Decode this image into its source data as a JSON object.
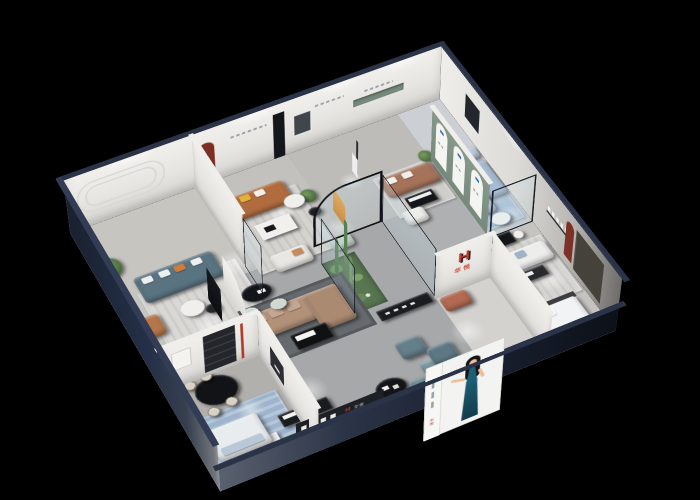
{
  "scene": {
    "description": "3D isometric cutaway render of a furniture brand showroom floor plan on a black background",
    "background": "#000000"
  },
  "brand": {
    "logo_letter": "H",
    "name": "华悦",
    "logo_color_primary": "#c23b2b",
    "logo_color_secondary": "#17181c"
  },
  "poster": {
    "subject": "woman in a dark teal evening dress on white lightbox panel",
    "background": "#f3f3f1",
    "dress_color": "#1d5f74",
    "seal_text": "华悦"
  },
  "palette": {
    "outer_wall_navy": "#212a3d",
    "inner_wall_white": "#ebe9e6",
    "floor_gray": "#aeb0b1",
    "green_accent_wall": "#7f9383",
    "red_arch_niche": "#7c2e22",
    "sofa_teal": "#5a7381",
    "sofa_caramel": "#b06c3e",
    "sofa_tan": "#b29179",
    "sofa_brown": "#a5735a",
    "sofa_light_blue": "#a6bbd4",
    "orange_accent": "#df8f2e",
    "rug_blue": "#a9bfd4",
    "plant_green": "#4e7347",
    "ottoman_teal": "#6d8c94"
  },
  "rooms": [
    {
      "id": "lounge-teal",
      "furniture": [
        "teal-sofa",
        "caramel-armchair",
        "round-coffee-tables",
        "floor-plant",
        "striped-rug",
        "wall-molding"
      ]
    },
    {
      "id": "lounge-caramel",
      "furniture": [
        "caramel-leather-sofa",
        "white-coffee-table",
        "white-loveseat",
        "red-arch-niche",
        "black-media-slab"
      ]
    },
    {
      "id": "gallery-middle",
      "furniture": [
        "orange-lounge",
        "sculpture-pedestal",
        "round-side-table",
        "wall-mirror",
        "rounded-glass-partition"
      ]
    },
    {
      "id": "lounge-brown",
      "furniture": [
        "brown-leather-sofa",
        "black-coffee-table",
        "white-armchair",
        "green-wall-niche"
      ]
    },
    {
      "id": "glass-room-blue",
      "furniture": [
        "blue-fabric-sofa",
        "blue-chaise",
        "white-round-table",
        "blue-rug",
        "green-arch-banner-wall"
      ]
    },
    {
      "id": "showroom-right",
      "furniture": [
        "white-sofa-set",
        "black-dining-table",
        "white-chairs",
        "display-bed",
        "red-arch-niche",
        "dark-wall-panel"
      ]
    },
    {
      "id": "central-showcase",
      "furniture": [
        "tan-sectional-sofa",
        "black-white-coffee-table",
        "dark-rug",
        "curved-partition",
        "black-oval-table",
        "mint-ottoman",
        "cactus-terrarium"
      ]
    },
    {
      "id": "reception-front",
      "furniture": [
        "black-round-table",
        "teal-cube-ottomans",
        "slate-armchairs",
        "logo-shelf",
        "display-benches",
        "brand-logo-wall",
        "poster-lightbox"
      ]
    },
    {
      "id": "bar-corner",
      "furniture": [
        "black-oval-bar-table",
        "cream-stools",
        "shelf-unit",
        "red-floor-lamp",
        "white-sideboard"
      ]
    },
    {
      "id": "bedroom-corner",
      "furniture": [
        "white-display-bed",
        "white-bench",
        "black-benches",
        "blue-patterned-rug"
      ]
    }
  ]
}
